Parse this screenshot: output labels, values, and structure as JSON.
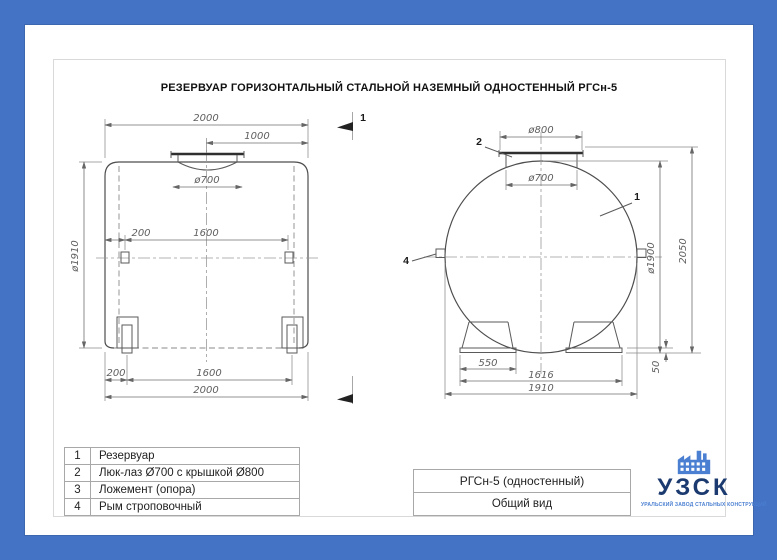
{
  "title": "РЕЗЕРВУАР ГОРИЗОНТАЛЬНЫЙ СТАЛЬНОЙ НАЗЕМНЫЙ ОДНОСТЕННЫЙ РГСн-5",
  "colors": {
    "border_blue": "#4472c4",
    "logo_navy": "#1b3a6f",
    "logo_blue": "#4a7fd1",
    "line_gray": "#4d4d4d"
  },
  "section_marker": {
    "label": "1"
  },
  "side_view": {
    "dim_length_top": "2000",
    "dim_half_length": "1000",
    "dim_manhole": "ø700",
    "dim_diameter": "ø1910",
    "dim_eye_offset": "200",
    "dim_eye_spacing": "1600",
    "dim_support_offset": "200",
    "dim_support_spacing": "1600",
    "dim_length_bottom": "2000"
  },
  "end_view": {
    "dim_cover": "ø800",
    "dim_manhole": "ø700",
    "dim_diameter": "ø1900",
    "dim_height": "2050",
    "dim_saddle_width": "550",
    "dim_saddle_span": "1616",
    "dim_overall_width": "1910",
    "dim_base_height": "50",
    "callout_tank": "1",
    "callout_manhole": "2",
    "callout_eye": "4"
  },
  "parts_table": {
    "rows": [
      {
        "num": "1",
        "name": "Резервуар"
      },
      {
        "num": "2",
        "name": "Люк-лаз Ø700 с крышкой Ø800"
      },
      {
        "num": "3",
        "name": "Ложемент (опора)"
      },
      {
        "num": "4",
        "name": "Рым строповочный"
      }
    ]
  },
  "title_block": {
    "model": "РГСн-5 (одностенный)",
    "view_name": "Общий вид"
  },
  "logo": {
    "abbr": "УЗСК",
    "subtitle": "УРАЛЬСКИЙ ЗАВОД СТАЛЬНЫХ КОНСТРУКЦИЙ"
  }
}
